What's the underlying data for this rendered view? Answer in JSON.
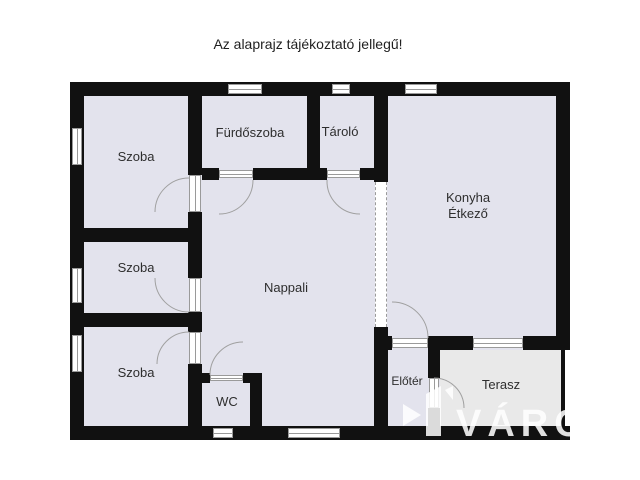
{
  "title": "Az alaprajz tájékoztató jellegű!",
  "floorplan": {
    "rooms": {
      "szoba_top": {
        "label": "Szoba"
      },
      "szoba_middle": {
        "label": "Szoba"
      },
      "szoba_bottom": {
        "label": "Szoba"
      },
      "furdoszoba": {
        "label": "Fürdőszoba"
      },
      "tarolo": {
        "label": "Tároló"
      },
      "konyha_etkezo": {
        "label_line1": "Konyha",
        "label_line2": "Étkező"
      },
      "nappali": {
        "label": "Nappali"
      },
      "wc": {
        "label": "WC"
      },
      "eloter": {
        "label": "Előtér"
      },
      "terasz": {
        "label": "Terasz"
      }
    },
    "colors": {
      "wall": "#111111",
      "room_fill": "#e3e3ed",
      "terrace_fill": "#e9e9e9",
      "frame": "#9a9a9a"
    }
  },
  "watermark": {
    "text": "VÁRO"
  }
}
